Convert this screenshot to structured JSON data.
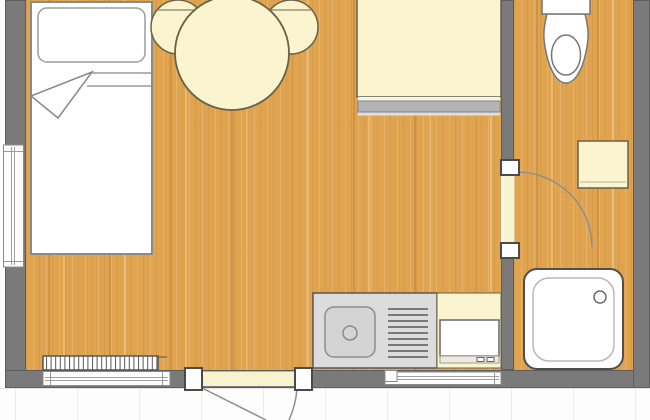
{
  "plan": {
    "type": "studio-apartment-floor-plan",
    "view": "top-down",
    "width_px": 650,
    "height_px": 420
  },
  "palette": {
    "floor_wood": "#e0a450",
    "wall_gray": "#7a7a7a",
    "furniture_cream": "#faf5cf",
    "furniture_cream_border": "#6a6148",
    "fixture_white": "#ffffff",
    "fixture_outline": "#6e6e6e",
    "dark_outline": "#4a4a4a",
    "counter_gray": "#dcdcdc",
    "sink_gray": "#d4d4d4",
    "desk_edge_gray": "#b4b4b4",
    "window_frame": "#8a8a8a",
    "door_swing_line": "#8f8f8f",
    "threshold_cream": "#f8f3cf",
    "terrace_joint_line": "#ececec"
  },
  "rooms": [
    {
      "name": "main-room",
      "floor": "wood"
    },
    {
      "name": "bathroom",
      "floor": "wood"
    },
    {
      "name": "terrace",
      "floor": "white-paving"
    }
  ],
  "furniture": [
    "single-bed-with-pillow-and-folded-blanket",
    "round-dining-table",
    "round-chair-left",
    "round-chair-right",
    "desk-sideboard",
    "kitchenette-counter",
    "kitchen-sink-with-drain",
    "dish-drainer",
    "cooker-appliance",
    "radiator"
  ],
  "fixtures": [
    "toilet-with-cistern",
    "washbasin-cabinet",
    "square-shower-tray-with-drain"
  ],
  "openings": [
    {
      "name": "window-left-wall"
    },
    {
      "name": "window-bottom-left"
    },
    {
      "name": "window-bottom-center"
    },
    {
      "name": "entrance-door",
      "swing": "outward-to-terrace",
      "hinge": "left"
    },
    {
      "name": "bathroom-door",
      "swing": "into-bathroom",
      "hinge": "bottom"
    }
  ]
}
